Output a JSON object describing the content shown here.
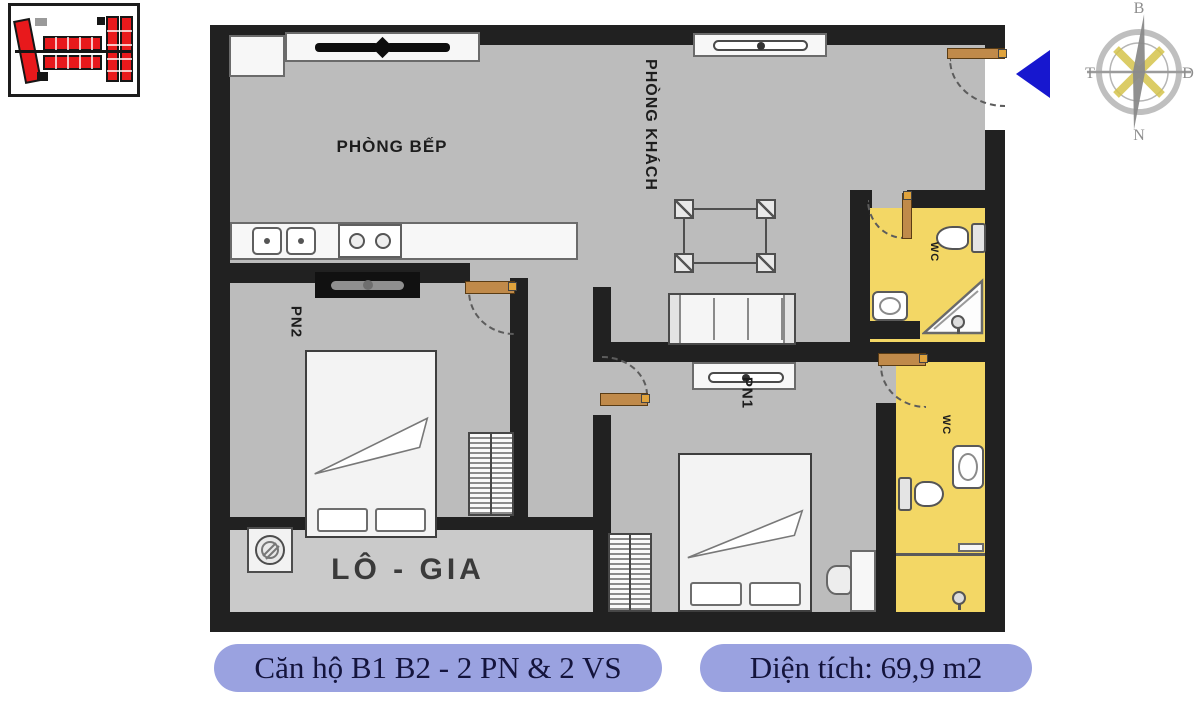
{
  "title": "Apartment B1 B2 floor plan",
  "rooms": {
    "kitchen": {
      "label": "PHÒNG BẾP"
    },
    "living": {
      "label": "PHÒNG KHÁCH"
    },
    "bedroom2": {
      "label": "PN2"
    },
    "bedroom1": {
      "label": "PN1"
    },
    "loggia": {
      "label": "LÔ - GIA"
    },
    "wc_top": {
      "label": "WC"
    },
    "wc_bottom": {
      "label": "WC"
    }
  },
  "compass": {
    "north": "B",
    "south": "N",
    "east": "D",
    "west": "T"
  },
  "footer": {
    "unit_label": "Căn hộ B1 B2 - 2 PN & 2 VS",
    "area_label": "Diện tích: 69,9 m2"
  },
  "colors": {
    "floor": "#bcbcbc",
    "loggia_floor": "#cacaca",
    "wall": "#212121",
    "wc_floor": "#f3d765",
    "door": "#c08a4a",
    "entrance_arrow": "#1717cf",
    "pill_bg": "#9aa2e0",
    "pill_text": "#14143c",
    "keyplan_red": "#e8191c"
  },
  "furniture_symbols": [
    "fridge",
    "kitchen-sink",
    "stove",
    "wardrobe",
    "double-bed",
    "pillow",
    "dresser",
    "washing-machine",
    "dining-table",
    "chair",
    "sofa",
    "window",
    "door",
    "desk",
    "desk-chair",
    "toilet",
    "wash-basin",
    "corner-shower",
    "floor-drain"
  ]
}
